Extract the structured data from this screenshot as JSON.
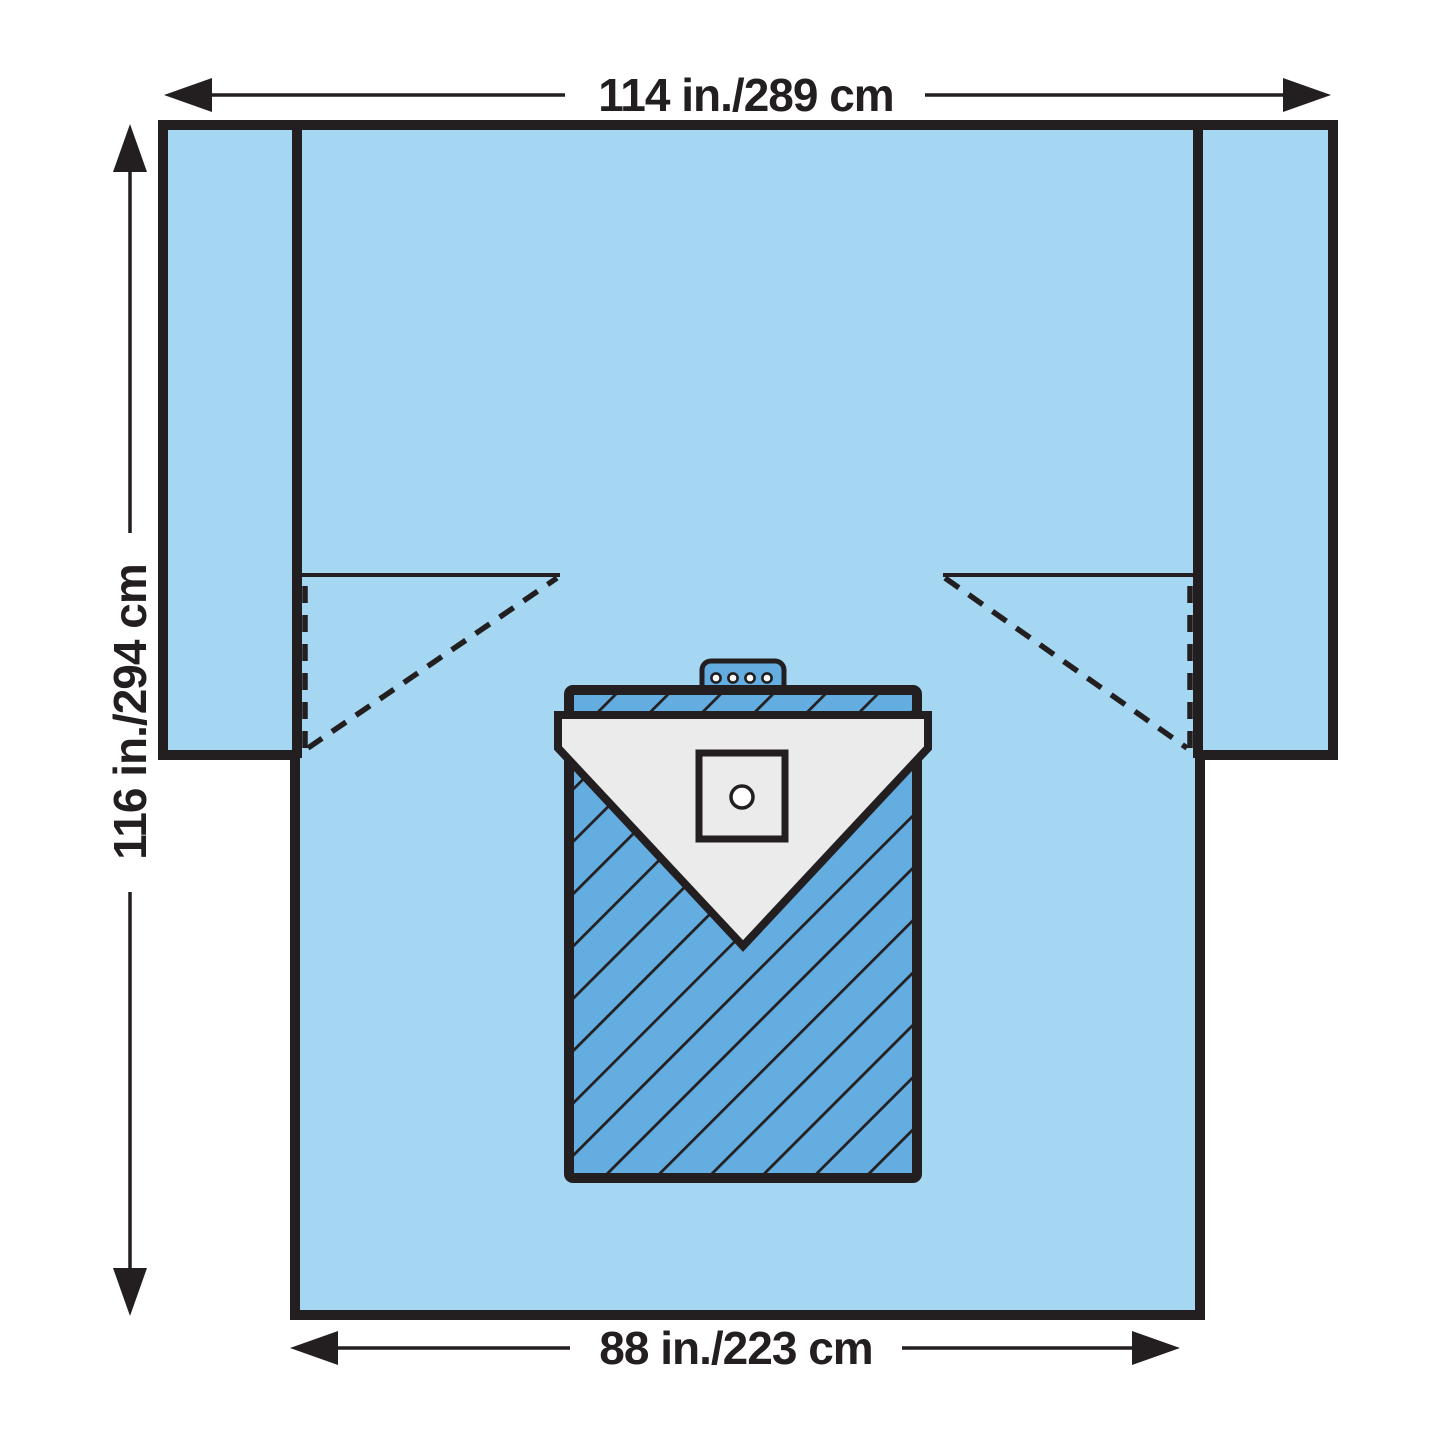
{
  "diagram": {
    "type": "surgical-drape-dimension-diagram",
    "labels": {
      "top_width": "114 in./289 cm",
      "side_height": "116 in./294 cm",
      "bottom_width": "88 in./223 cm"
    },
    "colors": {
      "background": "#ffffff",
      "drape_blue": "#a6d7f2",
      "reinforcement_blue": "#63ade0",
      "pouch_gray": "#ebebeb",
      "hole_white": "#ffffff",
      "outline_black": "#231f20"
    }
  }
}
